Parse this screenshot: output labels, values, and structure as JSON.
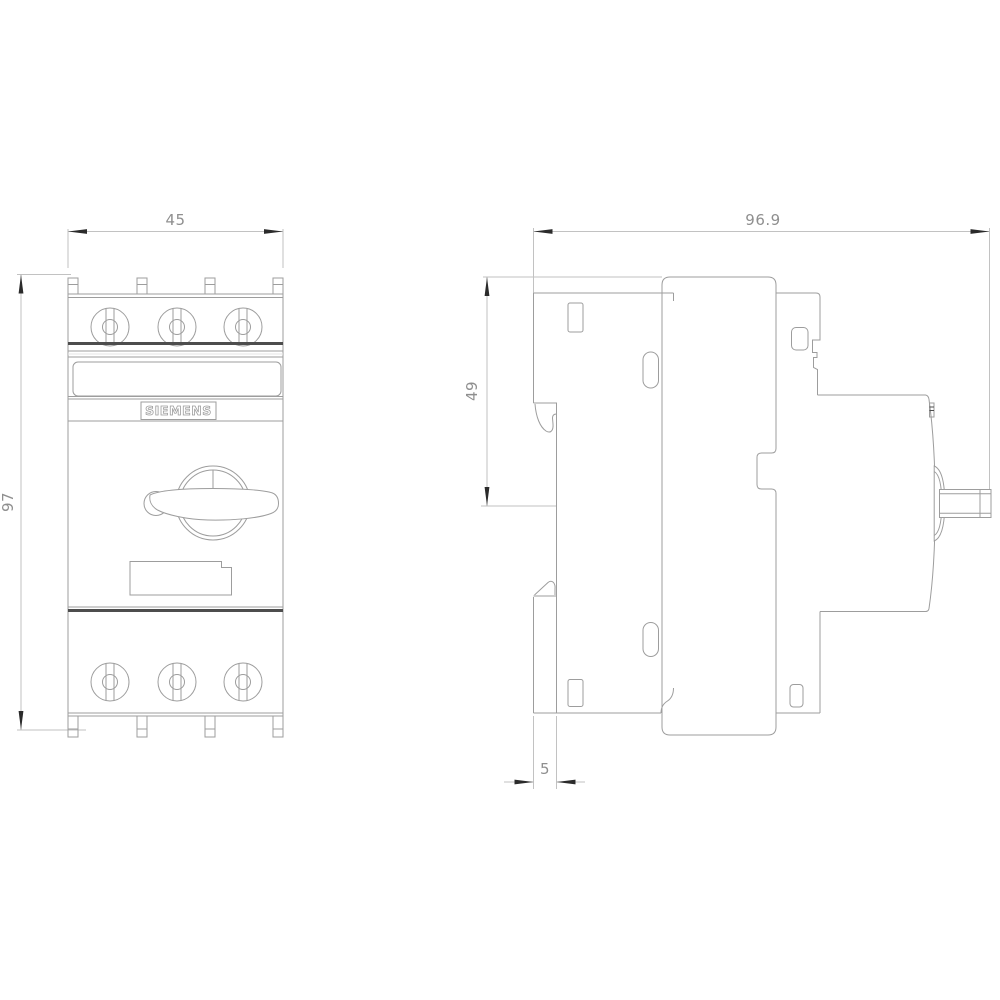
{
  "drawing": {
    "brand_label": "SIEMENS",
    "views": {
      "front": {
        "title": "front-view",
        "dimensions": {
          "width": {
            "label": "45"
          },
          "height": {
            "label": "97"
          }
        }
      },
      "side": {
        "title": "side-view",
        "dimensions": {
          "depth": {
            "label": "96.9"
          },
          "upper_depth": {
            "label": "49"
          },
          "rail_offset": {
            "label": "5"
          }
        }
      }
    },
    "colors": {
      "background": "#ffffff",
      "outline": "#9d9d9d",
      "faint_line": "#e6e6e6",
      "dimension_line": "#c2c2c2",
      "arrow": "#2b2b2b",
      "dimension_text": "#8f8f8f",
      "accent_dark": "#4d4d4d"
    }
  }
}
